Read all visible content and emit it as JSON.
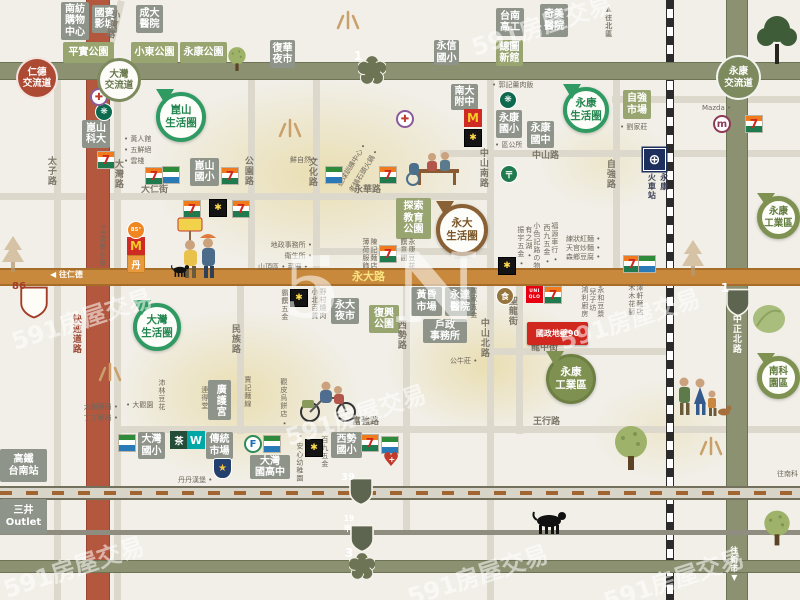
{
  "source_watermark": "591房屋交易",
  "palette": {
    "bg": "#f1efe8",
    "freeway": "#8b9171",
    "yongda_road": "#c8893c",
    "expressway": "#b3573f",
    "accent_red": "#d0271e",
    "pin_green": "#2f9b63",
    "pin_brown": "#8a6134"
  },
  "property": {
    "text": "國政地壁90",
    "x": 527,
    "y": 322,
    "w": 61,
    "h": 23
  },
  "interchanges": [
    {
      "text": "仁德\n交流道",
      "style": "red",
      "x": 16,
      "y": 57,
      "d": 42
    },
    {
      "text": "大灣\n交流道",
      "style": "outline",
      "x": 97,
      "y": 58,
      "d": 44
    },
    {
      "text": "永康\n交流道",
      "style": "solid",
      "x": 716,
      "y": 55,
      "d": 45
    }
  ],
  "pins": [
    {
      "n": "kunshan-circle-pin",
      "text": "崑山\n生活圈",
      "style": "go",
      "x": 156,
      "y": 92,
      "d": 50
    },
    {
      "n": "yongkang-circle-pin",
      "text": "永康\n生活圈",
      "style": "go",
      "x": 563,
      "y": 87,
      "d": 46
    },
    {
      "n": "dawan-circle-pin",
      "text": "大灣\n生活圈",
      "style": "go",
      "x": 133,
      "y": 303,
      "d": 48
    },
    {
      "n": "yongda-circle-pin",
      "text": "永大\n生活圈",
      "style": "bo",
      "x": 436,
      "y": 204,
      "d": 52
    },
    {
      "n": "yongkang-industrial-pin",
      "text": "永康\n工業區",
      "style": "gs",
      "x": 546,
      "y": 354,
      "d": 50
    },
    {
      "n": "yongkang-industrial-pin",
      "text": "永康\n工業區",
      "style": "gos",
      "x": 757,
      "y": 196,
      "d": 43
    },
    {
      "n": "nanke-park-pin",
      "text": "南科\n園區",
      "style": "gos",
      "x": 757,
      "y": 356,
      "d": 43
    }
  ],
  "boxes": [
    {
      "kind": "gray",
      "text": "南紡\n購物\n中心",
      "x": 61,
      "y": 2,
      "w": 28,
      "h": 38
    },
    {
      "kind": "gray",
      "text": "國賓\n影城",
      "x": 92,
      "y": 5,
      "w": 25,
      "h": 28
    },
    {
      "kind": "gray",
      "text": "成大\n醫院",
      "x": 136,
      "y": 5,
      "w": 27,
      "h": 28
    },
    {
      "kind": "gray",
      "text": "復華\n夜市",
      "x": 270,
      "y": 40,
      "w": 25,
      "h": 28
    },
    {
      "kind": "gray",
      "text": "永信\n國小",
      "x": 434,
      "y": 40,
      "w": 25,
      "h": 25
    },
    {
      "kind": "gray",
      "text": "台南\n高工",
      "x": 496,
      "y": 8,
      "w": 28,
      "h": 28
    },
    {
      "kind": "gray",
      "text": "奇美\n醫院",
      "x": 540,
      "y": 4,
      "w": 28,
      "h": 33
    },
    {
      "kind": "gray",
      "text": "南大\n附中",
      "x": 451,
      "y": 84,
      "w": 27,
      "h": 26
    },
    {
      "kind": "gray",
      "text": "永康\n國小",
      "x": 496,
      "y": 110,
      "w": 26,
      "h": 28
    },
    {
      "kind": "gray",
      "text": "永康\n國中",
      "x": 527,
      "y": 121,
      "w": 27,
      "h": 27
    },
    {
      "kind": "gray",
      "text": "崑山\n科大",
      "x": 82,
      "y": 120,
      "w": 28,
      "h": 28
    },
    {
      "kind": "gray",
      "text": "崑山\n國小",
      "x": 190,
      "y": 158,
      "w": 29,
      "h": 28
    },
    {
      "kind": "gray",
      "text": "永大\n夜市",
      "x": 331,
      "y": 298,
      "w": 28,
      "h": 26
    },
    {
      "kind": "gray",
      "text": "黃昏\n市場",
      "x": 411,
      "y": 287,
      "w": 31,
      "h": 29
    },
    {
      "kind": "gray",
      "text": "永達\n醫院",
      "x": 445,
      "y": 287,
      "w": 30,
      "h": 29
    },
    {
      "kind": "gray",
      "text": "戶政\n事務所",
      "x": 423,
      "y": 319,
      "w": 44,
      "h": 24
    },
    {
      "kind": "gray",
      "text": "廣護宮",
      "x": 208,
      "y": 380,
      "w": 23,
      "h": 40,
      "v": 1
    },
    {
      "kind": "gray",
      "text": "大灣\n國小",
      "x": 138,
      "y": 432,
      "w": 27,
      "h": 27
    },
    {
      "kind": "gray",
      "text": "傳統\n市場",
      "x": 206,
      "y": 432,
      "w": 27,
      "h": 27
    },
    {
      "kind": "gray",
      "text": "大灣\n國高中",
      "x": 250,
      "y": 455,
      "w": 40,
      "h": 24
    },
    {
      "kind": "gray",
      "text": "西勢\n國小",
      "x": 331,
      "y": 432,
      "w": 31,
      "h": 26
    },
    {
      "kind": "gray",
      "text": "高鐵\n台南站",
      "x": 0,
      "y": 449,
      "w": 47,
      "h": 33
    },
    {
      "kind": "gray",
      "text": "三井\nOutlet",
      "x": 0,
      "y": 499,
      "w": 47,
      "h": 35
    },
    {
      "kind": "green",
      "text": "平實公園",
      "x": 63,
      "y": 42,
      "w": 51,
      "h": 21
    },
    {
      "kind": "green",
      "text": "小東公園",
      "x": 131,
      "y": 42,
      "w": 47,
      "h": 21
    },
    {
      "kind": "green",
      "text": "永康公園",
      "x": 180,
      "y": 42,
      "w": 47,
      "h": 21
    },
    {
      "kind": "green",
      "text": "總圖\n新館",
      "x": 496,
      "y": 40,
      "w": 27,
      "h": 26
    },
    {
      "kind": "green",
      "text": "自強\n市場",
      "x": 623,
      "y": 90,
      "w": 28,
      "h": 29
    },
    {
      "kind": "green",
      "text": "探索\n教育\n公園",
      "x": 396,
      "y": 198,
      "w": 35,
      "h": 41
    },
    {
      "kind": "green",
      "text": "復興\n公園",
      "x": 369,
      "y": 305,
      "w": 30,
      "h": 28
    }
  ],
  "roadLabels": [
    {
      "text": "小東路",
      "x": 110,
      "y": 8,
      "v": 1,
      "rot": 14
    },
    {
      "text": "太子路",
      "x": 45,
      "y": 156,
      "v": 1
    },
    {
      "text": "大灣路",
      "x": 112,
      "y": 159,
      "v": 1
    },
    {
      "text": "公園路",
      "x": 242,
      "y": 156,
      "v": 1
    },
    {
      "text": "大仁街",
      "x": 141,
      "y": 186
    },
    {
      "text": "文化路",
      "x": 306,
      "y": 157,
      "v": 1
    },
    {
      "text": "永華路",
      "x": 354,
      "y": 186
    },
    {
      "text": "中山南路",
      "x": 477,
      "y": 148,
      "v": 1
    },
    {
      "text": "中山路",
      "x": 532,
      "y": 152
    },
    {
      "text": "自強路",
      "x": 604,
      "y": 159,
      "v": 1
    },
    {
      "text": "民族路",
      "x": 229,
      "y": 324,
      "v": 1
    },
    {
      "text": "西勢路",
      "x": 395,
      "y": 320,
      "v": 1
    },
    {
      "text": "中山北路",
      "x": 478,
      "y": 318,
      "v": 1
    },
    {
      "text": "聖龍街",
      "x": 506,
      "y": 296,
      "v": 1
    },
    {
      "text": "龍中街",
      "x": 531,
      "y": 344
    },
    {
      "text": "王行路",
      "x": 533,
      "y": 418
    },
    {
      "text": "富強路",
      "x": 352,
      "y": 418
    },
    {
      "text": "快速道路",
      "x": 70,
      "y": 314,
      "v": 1,
      "c": "red"
    },
    {
      "text": "中正北路",
      "x": 730,
      "y": 314,
      "v": 1,
      "c": "white"
    },
    {
      "text": "▲往北區",
      "x": 604,
      "y": 5,
      "v": 1,
      "size": 7
    },
    {
      "text": "往新市▼",
      "x": 729,
      "y": 546,
      "v": 1,
      "c": "white",
      "size": 8
    },
    {
      "text": "◀ 往仁德",
      "x": 50,
      "y": 271,
      "c": "white",
      "size": 8
    },
    {
      "text": "永大路",
      "x": 352,
      "y": 271,
      "c": "gold",
      "size": 11
    }
  ],
  "smallLabels": [
    {
      "text": "• 黃人館\n• 五鮮絕\n• 雲棧",
      "x": 124,
      "y": 134,
      "w": 42,
      "align": "left"
    },
    {
      "text": "54清粥小菜",
      "x": 97,
      "y": 224,
      "v": 1
    },
    {
      "text": "鮮自然 •",
      "x": 290,
      "y": 155
    },
    {
      "text": "壘球訓練中心 •",
      "x": 344,
      "y": 178,
      "rot": -58
    },
    {
      "text": "老鍋石頭火鍋 •",
      "x": 356,
      "y": 184,
      "rot": -58
    },
    {
      "text": "• 郭記羹肉飯",
      "x": 492,
      "y": 80
    },
    {
      "text": "• 區公所",
      "x": 495,
      "y": 140
    },
    {
      "text": "• 劉家莊",
      "x": 620,
      "y": 122
    },
    {
      "text": "Mazda •",
      "x": 702,
      "y": 103
    },
    {
      "text": "地政事務所 •\n衛生所 •",
      "x": 252,
      "y": 240,
      "w": 60,
      "align": "right"
    },
    {
      "text": "山頂區 • 菜廟 •",
      "x": 258,
      "y": 262
    },
    {
      "text": "霸饌五金",
      "x": 279,
      "y": 289,
      "v": 1
    },
    {
      "text": "小北百貨",
      "x": 309,
      "y": 288,
      "v": 1
    },
    {
      "text": "野村燒肉",
      "x": 317,
      "y": 288,
      "v": 1
    },
    {
      "text": "振宇五金 •",
      "x": 515,
      "y": 226,
      "v": 1
    },
    {
      "text": "有之湖 •",
      "x": 523,
      "y": 226,
      "v": 1
    },
    {
      "text": "小色記路の物",
      "x": 531,
      "y": 222,
      "v": 1
    },
    {
      "text": "西九五金 •",
      "x": 541,
      "y": 224,
      "v": 1
    },
    {
      "text": "福源車行 •",
      "x": 549,
      "y": 222,
      "v": 1
    },
    {
      "text": "練狀紅麵 •",
      "x": 566,
      "y": 234
    },
    {
      "text": "天官炒麵 •",
      "x": 566,
      "y": 243
    },
    {
      "text": "森鄉豆腐 •",
      "x": 566,
      "y": 252
    },
    {
      "text": "鴻利廚房",
      "x": 579,
      "y": 286,
      "v": 1
    },
    {
      "text": "兒子坊",
      "x": 587,
      "y": 288,
      "v": 1
    },
    {
      "text": "永和豆漿",
      "x": 595,
      "y": 286,
      "v": 1
    },
    {
      "text": "木木花藝",
      "x": 626,
      "y": 284,
      "v": 1
    },
    {
      "text": "澤軒麵店",
      "x": 634,
      "y": 284,
      "v": 1
    },
    {
      "text": "買家五金",
      "x": 468,
      "y": 287,
      "v": 1
    },
    {
      "text": "公牛莊 •",
      "x": 450,
      "y": 356
    },
    {
      "text": "丹丹漢堡 •",
      "x": 178,
      "y": 475
    },
    {
      "text": "沛林豆花",
      "x": 156,
      "y": 379,
      "v": 1
    },
    {
      "text": "• 大觀園",
      "x": 126,
      "y": 400
    },
    {
      "text": "連得堂",
      "x": 199,
      "y": 386,
      "v": 1
    },
    {
      "text": "• 安心幼稚園",
      "x": 294,
      "y": 434,
      "v": 1
    },
    {
      "text": "百九五金",
      "x": 319,
      "y": 436,
      "v": 1
    },
    {
      "text": "觀皮烏餅店 •",
      "x": 278,
      "y": 378,
      "v": 1
    },
    {
      "text": "賈記麵線",
      "x": 242,
      "y": 376,
      "v": 1
    },
    {
      "text": "大樹藥局 •\n丁丁藥局 •",
      "x": 70,
      "y": 402,
      "w": 48,
      "align": "right"
    },
    {
      "text": "薄荷服飾",
      "x": 360,
      "y": 238,
      "v": 1
    },
    {
      "text": "陳記麵店",
      "x": 368,
      "y": 238,
      "v": 1
    },
    {
      "text": "饌意間",
      "x": 398,
      "y": 238,
      "v": 1
    },
    {
      "text": "永康豆花",
      "x": 406,
      "y": 238,
      "v": 1
    },
    {
      "text": "往南科",
      "x": 777,
      "y": 469
    }
  ],
  "shields": [
    {
      "kind": "plum",
      "text": "1",
      "x": 358,
      "y": 56,
      "s": 28
    },
    {
      "kind": "plum",
      "text": "3",
      "x": 349,
      "y": 553,
      "s": 26
    },
    {
      "kind": "shield",
      "text": "1",
      "x": 725,
      "y": 288,
      "s": 26
    },
    {
      "kind": "shield",
      "text": "39",
      "x": 348,
      "y": 477,
      "s": 26
    },
    {
      "kind": "shield",
      "text": "19甲",
      "x": 349,
      "y": 524,
      "s": 26
    },
    {
      "kind": "shield86",
      "text": "86",
      "x": 19,
      "y": 286,
      "s": 30
    }
  ],
  "roads": {
    "major": [
      {
        "k": "redv",
        "x": 86,
        "y": 0,
        "w": 24,
        "h": 600
      },
      {
        "k": "olivev",
        "x": 726,
        "y": 0,
        "w": 22,
        "h": 600
      },
      {
        "k": "rail",
        "x": 666,
        "y": 0,
        "w": 8,
        "h": 600
      },
      {
        "k": "freeway",
        "x": 0,
        "y": 62,
        "w": 800,
        "h": 18
      },
      {
        "k": "orange",
        "x": 0,
        "y": 268,
        "w": 800,
        "h": 18
      },
      {
        "k": "dashed",
        "x": 0,
        "y": 486,
        "w": 800,
        "h": 14
      },
      {
        "k": "gray",
        "x": 0,
        "y": 530,
        "w": 800,
        "h": 5
      },
      {
        "k": "freeway",
        "x": 0,
        "y": 560,
        "w": 800,
        "h": 13
      }
    ],
    "minor": [
      {
        "x": 118,
        "y": 0,
        "w": 7,
        "h": 66,
        "rot": 14
      },
      {
        "x": 54,
        "y": 80,
        "w": 7,
        "h": 520
      },
      {
        "x": 114,
        "y": 80,
        "w": 7,
        "h": 520
      },
      {
        "x": 248,
        "y": 80,
        "w": 7,
        "h": 192
      },
      {
        "x": 313,
        "y": 80,
        "w": 7,
        "h": 225
      },
      {
        "x": 237,
        "y": 286,
        "w": 7,
        "h": 148
      },
      {
        "x": 403,
        "y": 268,
        "w": 7,
        "h": 265
      },
      {
        "x": 487,
        "y": 80,
        "w": 7,
        "h": 520
      },
      {
        "x": 516,
        "y": 286,
        "w": 7,
        "h": 148
      },
      {
        "x": 613,
        "y": 80,
        "w": 7,
        "h": 192
      },
      {
        "x": 440,
        "y": 150,
        "w": 360,
        "h": 7
      },
      {
        "x": 612,
        "y": 96,
        "w": 188,
        "h": 7
      },
      {
        "x": 0,
        "y": 193,
        "w": 487,
        "h": 7
      },
      {
        "x": 315,
        "y": 248,
        "w": 172,
        "h": 7
      },
      {
        "x": 487,
        "y": 348,
        "w": 185,
        "h": 7
      },
      {
        "x": 118,
        "y": 426,
        "w": 682,
        "h": 7
      }
    ]
  },
  "iconGlyphs": {
    "seven": "7",
    "pxs": "",
    "pxb": "✱",
    "mcd": "M",
    "c85": "85°",
    "burger": "丹",
    "sbux": "❋",
    "pharm": "✚",
    "post": "〒",
    "fami": "F",
    "tea": "茶",
    "wel": "W",
    "police": "★",
    "heart": "♥",
    "train": "⊕",
    "uniqlo": "UNI\nQLO",
    "mazda": "m",
    "shopround": "食"
  },
  "icons": [
    {
      "t": "seven",
      "x": 97,
      "y": 151
    },
    {
      "t": "seven",
      "x": 145,
      "y": 167
    },
    {
      "t": "seven",
      "x": 221,
      "y": 167
    },
    {
      "t": "seven",
      "x": 183,
      "y": 200
    },
    {
      "t": "seven",
      "x": 232,
      "y": 200
    },
    {
      "t": "seven",
      "x": 379,
      "y": 166
    },
    {
      "t": "seven",
      "x": 379,
      "y": 245
    },
    {
      "t": "seven",
      "x": 623,
      "y": 255
    },
    {
      "t": "seven",
      "x": 544,
      "y": 286
    },
    {
      "t": "seven",
      "x": 745,
      "y": 115
    },
    {
      "t": "seven",
      "x": 361,
      "y": 434
    },
    {
      "t": "pxs",
      "x": 162,
      "y": 166
    },
    {
      "t": "pxs",
      "x": 325,
      "y": 166
    },
    {
      "t": "pxs",
      "x": 638,
      "y": 255
    },
    {
      "t": "pxs",
      "x": 118,
      "y": 434
    },
    {
      "t": "pxs",
      "x": 263,
      "y": 435
    },
    {
      "t": "pxs",
      "x": 381,
      "y": 436
    },
    {
      "t": "pxb",
      "x": 464,
      "y": 129
    },
    {
      "t": "pxb",
      "x": 209,
      "y": 199
    },
    {
      "t": "pxb",
      "x": 290,
      "y": 289
    },
    {
      "t": "pxb",
      "x": 498,
      "y": 257
    },
    {
      "t": "pxb",
      "x": 305,
      "y": 439
    },
    {
      "t": "mcd",
      "x": 464,
      "y": 109
    },
    {
      "t": "mcd",
      "x": 127,
      "y": 237
    },
    {
      "t": "c85",
      "x": 127,
      "y": 221
    },
    {
      "t": "burger",
      "x": 127,
      "y": 255
    },
    {
      "t": "sbux",
      "x": 95,
      "y": 103
    },
    {
      "t": "sbux",
      "x": 499,
      "y": 91
    },
    {
      "t": "pharm",
      "x": 90,
      "y": 88
    },
    {
      "t": "pharm",
      "x": 396,
      "y": 110
    },
    {
      "t": "post",
      "x": 500,
      "y": 165
    },
    {
      "t": "fami",
      "x": 244,
      "y": 435
    },
    {
      "t": "tea",
      "x": 170,
      "y": 431
    },
    {
      "t": "wel",
      "x": 187,
      "y": 431
    },
    {
      "t": "police",
      "x": 213,
      "y": 458
    },
    {
      "t": "heart",
      "x": 382,
      "y": 451
    },
    {
      "t": "train",
      "x": 643,
      "y": 148
    },
    {
      "t": "uniqlo",
      "x": 526,
      "y": 286
    },
    {
      "t": "mazda",
      "x": 713,
      "y": 115
    },
    {
      "t": "shopround",
      "x": 496,
      "y": 287
    }
  ],
  "stationLabel": {
    "text": "永康\n火車站",
    "x": 645,
    "y": 173
  },
  "deco": [
    {
      "t": "rays",
      "x": 334,
      "y": 8
    },
    {
      "t": "rays",
      "x": 276,
      "y": 116
    },
    {
      "t": "rays",
      "x": 96,
      "y": 360
    },
    {
      "t": "rays",
      "x": 697,
      "y": 434
    },
    {
      "t": "tree",
      "x": 611,
      "y": 424,
      "s": 1
    },
    {
      "t": "tree",
      "x": 761,
      "y": 509,
      "s": 0.8
    },
    {
      "t": "tree",
      "x": 226,
      "y": 46,
      "s": 0.55
    },
    {
      "t": "treedark",
      "x": 755,
      "y": 14,
      "s": 1
    },
    {
      "t": "pine",
      "x": 680,
      "y": 238,
      "s": 1
    },
    {
      "t": "pine",
      "x": 0,
      "y": 234,
      "s": 1
    },
    {
      "t": "leaf",
      "x": 751,
      "y": 302,
      "s": 1
    },
    {
      "t": "bench",
      "x": 405,
      "y": 145,
      "s": 1
    },
    {
      "t": "couple",
      "x": 176,
      "y": 216,
      "s": 1
    },
    {
      "t": "bike",
      "x": 296,
      "y": 376,
      "s": 1
    },
    {
      "t": "family",
      "x": 674,
      "y": 374,
      "s": 1
    },
    {
      "t": "dog",
      "x": 531,
      "y": 508,
      "s": 1
    },
    {
      "t": "dog",
      "x": 170,
      "y": 263,
      "s": 0.55
    }
  ],
  "blobs": [
    {
      "x": 150,
      "y": 80,
      "w": 340,
      "h": 190
    },
    {
      "x": 118,
      "y": 310,
      "w": 240,
      "h": 170
    },
    {
      "x": 388,
      "y": 298,
      "w": 200,
      "h": 135
    },
    {
      "x": 592,
      "y": 380,
      "w": 150,
      "h": 100,
      "o": 0.5
    },
    {
      "x": 540,
      "y": 115,
      "w": 130,
      "h": 95,
      "o": 0.5
    }
  ],
  "watermarks": [
    {
      "text": "5",
      "x": 282,
      "y": 238,
      "size": 84,
      "big": 1
    },
    {
      "text": "N",
      "x": 392,
      "y": 232,
      "size": 96,
      "big": 1
    },
    {
      "text": "591房屋交易",
      "x": 8,
      "y": 300,
      "rot": -18
    },
    {
      "text": "591房屋交易",
      "x": 282,
      "y": 396,
      "rot": -18
    },
    {
      "text": "591房屋交易",
      "x": 556,
      "y": 300,
      "rot": -18
    },
    {
      "text": "591房屋交易",
      "x": 404,
      "y": 556,
      "rot": -18
    },
    {
      "text": "591房屋交易",
      "x": 600,
      "y": 560,
      "rot": -18
    },
    {
      "text": "591房屋交易",
      "x": 468,
      "y": 6,
      "rot": -18
    },
    {
      "text": "591房屋交易",
      "x": 0,
      "y": 548,
      "rot": -18
    }
  ]
}
